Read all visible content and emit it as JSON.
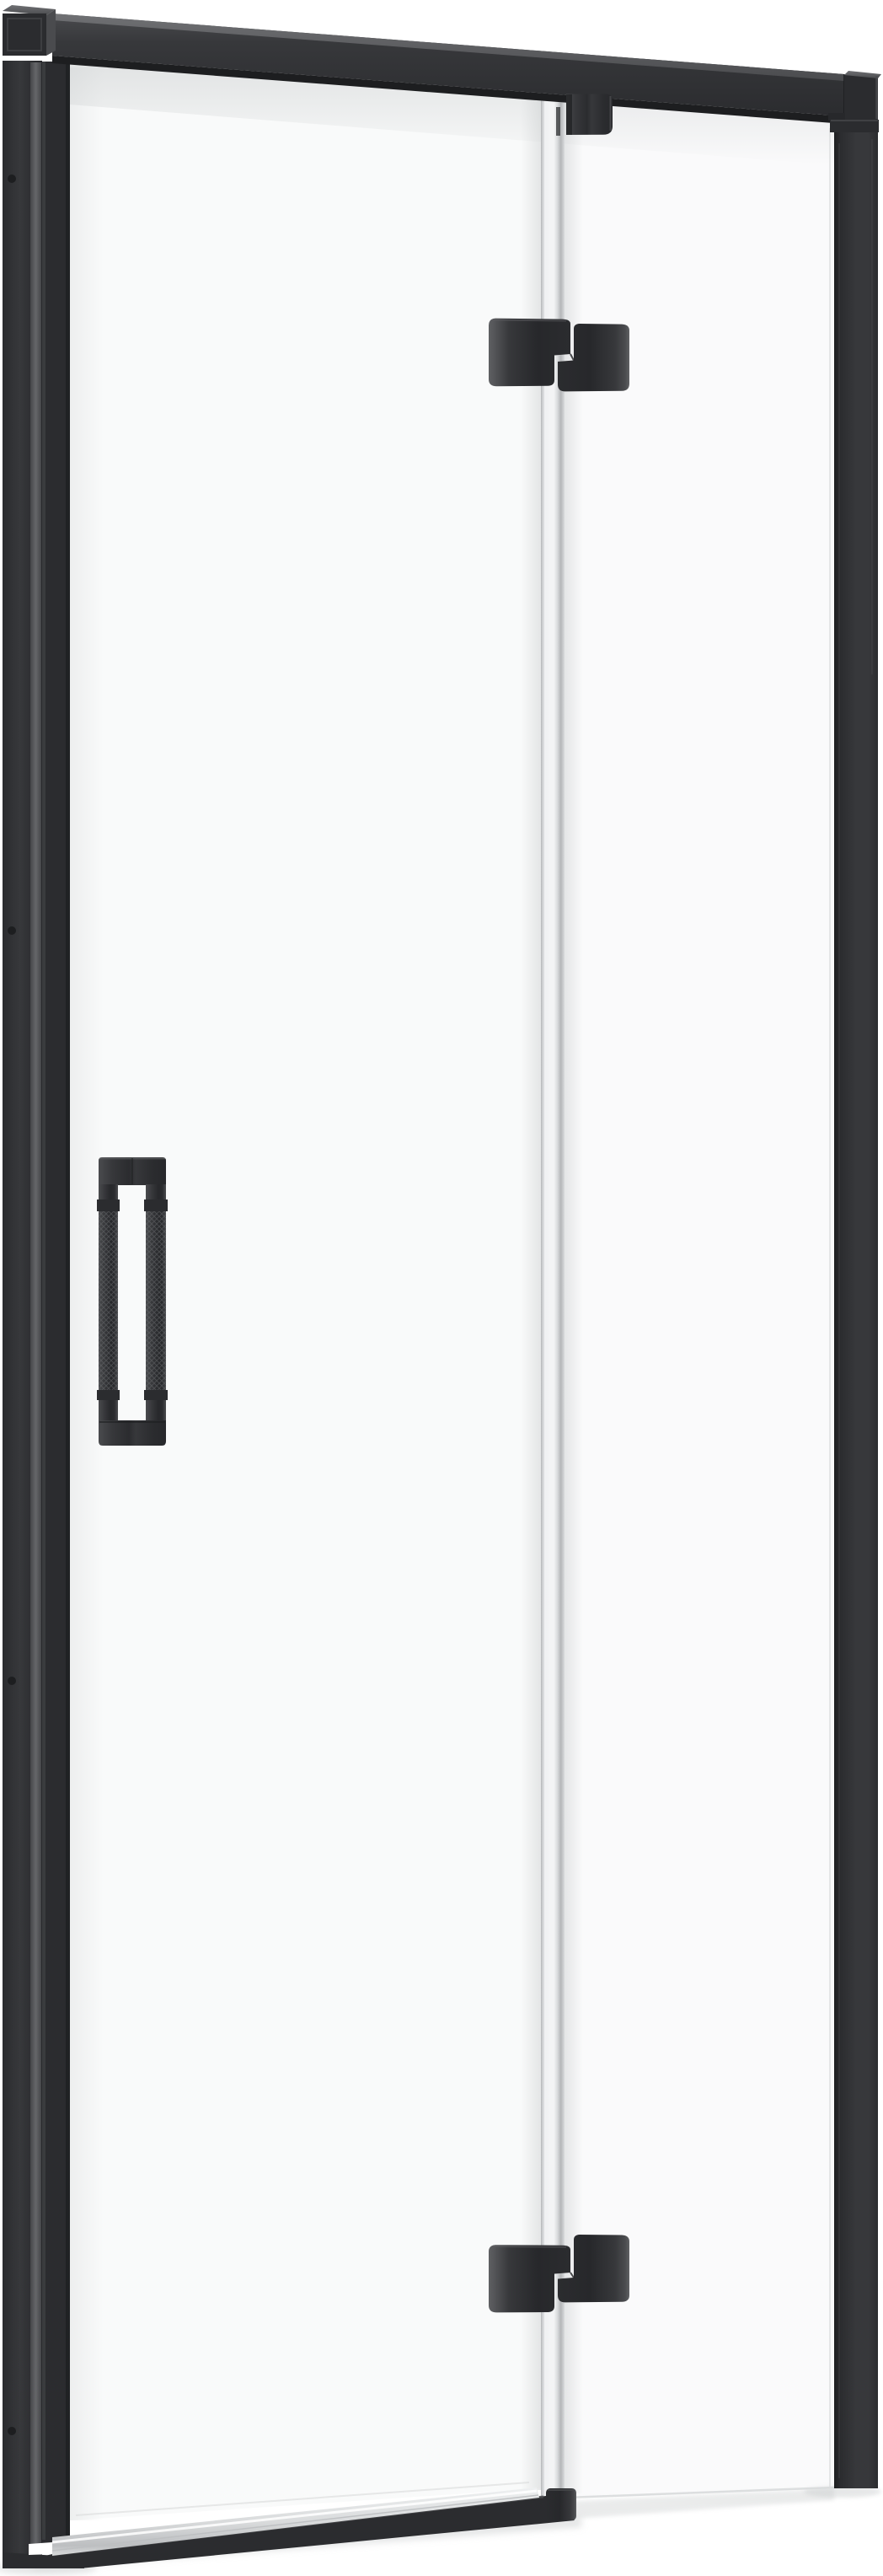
{
  "image": {
    "type": "product-render",
    "subject": "Black-framed hinged shower door with clear glass, right-side pivot hinges and vertical knurled bar handle, on white background",
    "background": "#ffffff"
  },
  "palette": {
    "white": "#ffffff",
    "frame": "#37383b",
    "frame_dark": "#2b2c2f",
    "frame_darker": "#1d1e20",
    "frame_light": "#4a4b4e",
    "frame_lighter": "#5f6063",
    "frame_lightest": "#707174",
    "near_black": "#27282b",
    "strip_core": "#f3f4f5",
    "strip_mid": "#d9dbdd",
    "strip_edge": "#b4b6b8",
    "silver_hi": "#eef0f1",
    "silver_mid": "#d9dbdc",
    "silver_lo": "#bdbfc1",
    "shadow": "#c9cccd",
    "glass_tint": "#f4f5f6",
    "glass_line": "#d8dadb"
  },
  "parts": [
    {
      "id": "top-support-bar",
      "label": "top support bar"
    },
    {
      "id": "wall-mount-cap",
      "label": "wall mount cap, top left"
    },
    {
      "id": "bar-end-cap",
      "label": "support bar end cap, top right"
    },
    {
      "id": "left-wall-profile",
      "label": "left wall profile"
    },
    {
      "id": "door-leaf-profile",
      "label": "door leaf edge profile"
    },
    {
      "id": "door-glass",
      "label": "door glass panel"
    },
    {
      "id": "fixed-panel-glass",
      "label": "fixed side panel glass"
    },
    {
      "id": "glass-edge-strip",
      "label": "polished glass hinge edge"
    },
    {
      "id": "glass-clamp-top",
      "label": "top glass clamp"
    },
    {
      "id": "hinge-upper",
      "label": "upper hinge"
    },
    {
      "id": "hinge-lower",
      "label": "lower hinge"
    },
    {
      "id": "door-handle",
      "label": "vertical bar handle with knurled grip"
    },
    {
      "id": "bottom-rail",
      "label": "bottom rail"
    },
    {
      "id": "threshold-strip",
      "label": "aluminium threshold strip"
    },
    {
      "id": "right-wall-post",
      "label": "right wall profile post"
    },
    {
      "id": "screw-holes",
      "label": "wall profile screw holes",
      "x": 14,
      "y": [
        212,
        1104,
        1994,
        2884
      ]
    },
    {
      "id": "floor-shadow",
      "label": "floor shadow"
    }
  ]
}
